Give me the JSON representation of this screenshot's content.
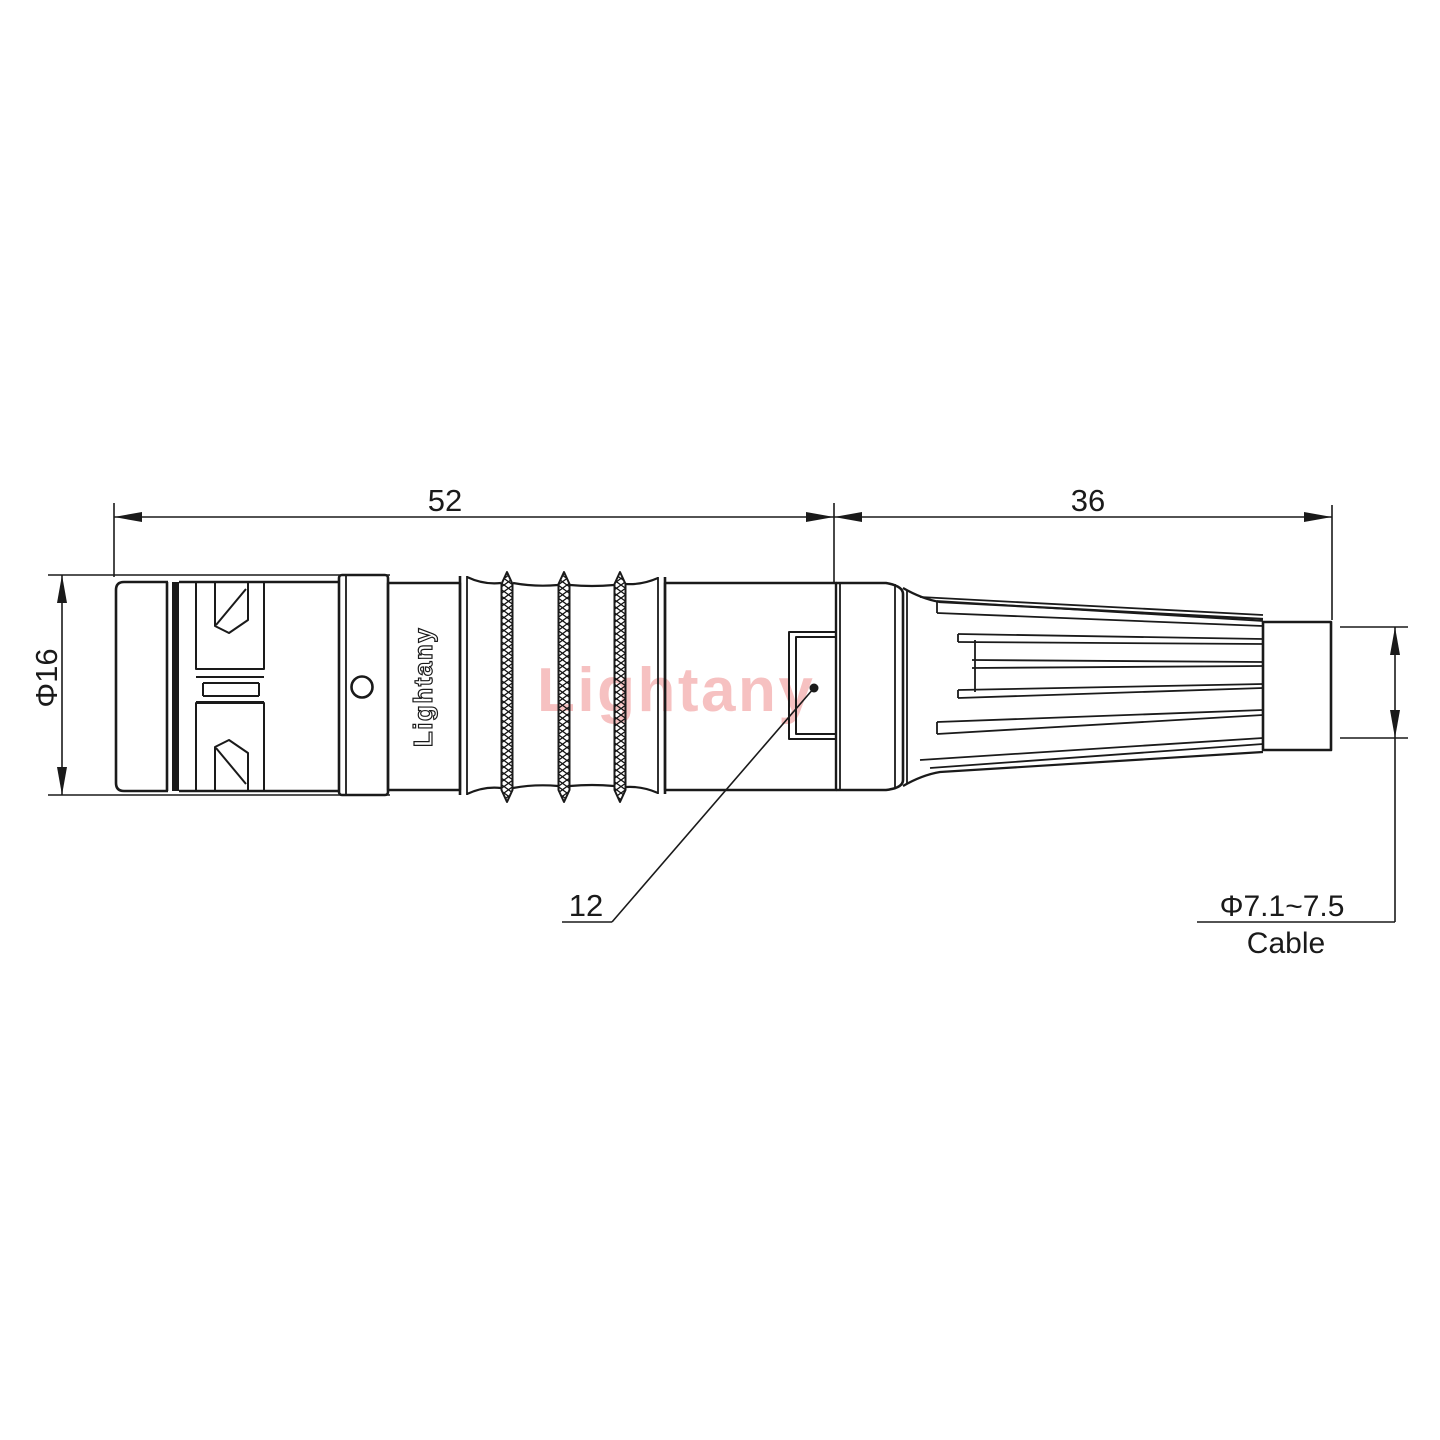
{
  "meta": {
    "type": "technical-drawing",
    "subject": "circular push-pull cable connector, side view with strain relief boot"
  },
  "colors": {
    "background": "#ffffff",
    "line": "#1a1a1a",
    "watermark": "#f5b6b6"
  },
  "watermark": {
    "text": "Lightany"
  },
  "engraving": {
    "text": "Lightany"
  },
  "dimensions": {
    "front_length": {
      "label": "52",
      "value": 52,
      "unit": "mm"
    },
    "rear_length": {
      "label": "36",
      "value": 36,
      "unit": "mm"
    },
    "front_diameter": {
      "label": "Φ16",
      "value": 16,
      "unit": "mm"
    },
    "leader": {
      "label": "12",
      "value": 12
    },
    "cable_diameter": {
      "label": "Φ7.1~7.5",
      "min": 7.1,
      "max": 7.5,
      "unit": "mm"
    },
    "cable_caption": {
      "label": "Cable"
    }
  }
}
